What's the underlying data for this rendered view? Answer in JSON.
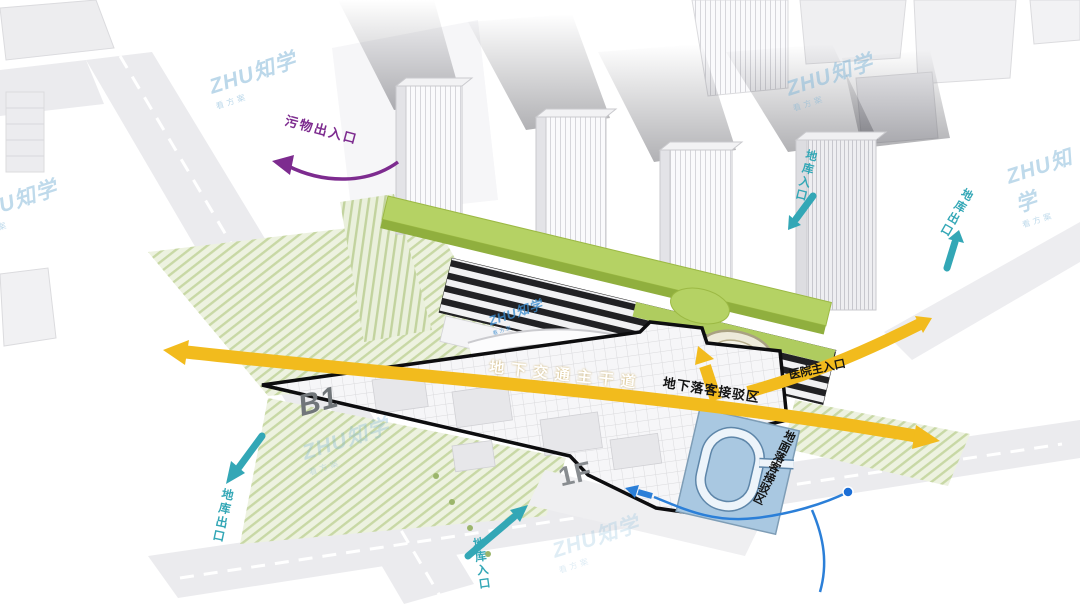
{
  "watermark": {
    "brand": "ZHU知学",
    "tagline": "看方案"
  },
  "annotations": {
    "waste_entrance": "污物出入口",
    "underground_main_road": "地下交通主干道",
    "underground_dropoff_zone": "地下落客接驳区",
    "hospital_main_entrance": "医院主入口",
    "ground_dropoff_loop": "地面落客接驳区",
    "garage_exit_west": "地库出口",
    "garage_entrance_south": "地库入口",
    "garage_entrance_north": "地库入口",
    "garage_exit_east": "地库出口",
    "level_b1": "B1",
    "level_1f": "1F"
  },
  "colors": {
    "accent_yellow": "#F2BB1D",
    "accent_purple": "#7D2B8F",
    "accent_teal": "#33A7B6",
    "accent_blue": "#2B7FD8",
    "roof_green": "#B5D264",
    "landscape_green": "#EDF2E0",
    "boundary_black": "#0D0D0F"
  }
}
